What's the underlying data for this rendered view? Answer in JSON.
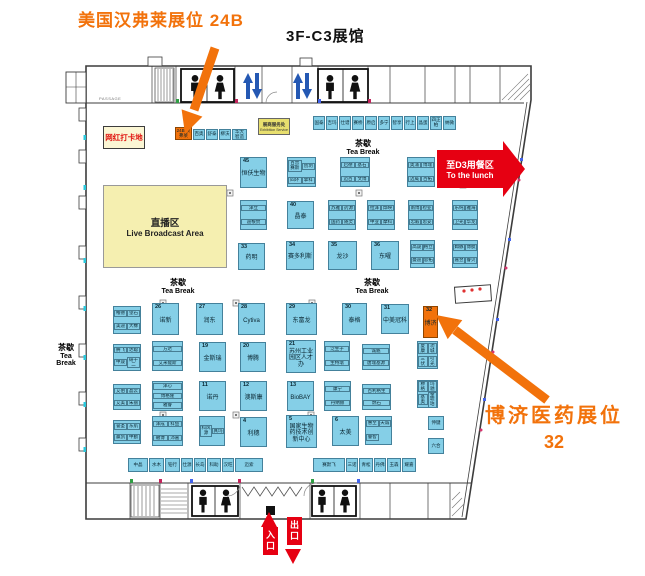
{
  "title": "3F-C3展馆",
  "annotations": {
    "humphrey": "美国汉弗莱展位 24B",
    "boji_line1": "博济医药展位",
    "boji_line2": "32"
  },
  "labels": {
    "tea_cn": "茶歇",
    "tea_en": "Tea Break",
    "photo_spot": "网红打卡地",
    "live_cn": "直播区",
    "live_en": "Live Broadcast Area",
    "service_cn": "展商服务处",
    "service_en": "Exhibition Service",
    "lunch_cn": "至D3用餐区",
    "lunch_en": "To the lunch",
    "entrance": "入口",
    "exit": "出口",
    "passage": "PASSAGE"
  },
  "colors": {
    "booth_blue": "#85CFE7",
    "highlight_orange": "#F2720B",
    "red": "#E60012",
    "area_yellow": "#F5EFB0"
  },
  "tea_break_spots": [
    {
      "x": 363,
      "y": 138,
      "v": false
    },
    {
      "x": 178,
      "y": 277,
      "v": false
    },
    {
      "x": 372,
      "y": 277,
      "v": false
    },
    {
      "x": 66,
      "y": 342,
      "v": true
    }
  ],
  "booths": [
    {
      "x": 175,
      "y": 127,
      "w": 17,
      "h": 13,
      "num": "24B",
      "label": "汉弗莱",
      "color": "orange",
      "mini": true
    },
    {
      "x": 193,
      "y": 129,
      "w": 12,
      "h": 11,
      "label": "百奥",
      "mini": true
    },
    {
      "x": 206,
      "y": 129,
      "w": 12,
      "h": 11,
      "label": "舒泰",
      "mini": true
    },
    {
      "x": 219,
      "y": 129,
      "w": 12,
      "h": 11,
      "label": "柳沃",
      "mini": true
    },
    {
      "x": 232,
      "y": 129,
      "w": 15,
      "h": 11,
      "label": "华大智造",
      "mini": true
    },
    {
      "x": 313,
      "y": 116,
      "w": 12,
      "h": 14,
      "label": "国泰",
      "mini": true
    },
    {
      "x": 326,
      "y": 116,
      "w": 12,
      "h": 14,
      "label": "吉玛",
      "mini": true
    },
    {
      "x": 339,
      "y": 116,
      "w": 12,
      "h": 14,
      "label": "仕谱",
      "mini": true
    },
    {
      "x": 352,
      "y": 116,
      "w": 12,
      "h": 14,
      "label": "赛桥",
      "mini": true
    },
    {
      "x": 365,
      "y": 116,
      "w": 12,
      "h": 14,
      "label": "原启",
      "mini": true
    },
    {
      "x": 378,
      "y": 116,
      "w": 12,
      "h": 14,
      "label": "多宁",
      "mini": true
    },
    {
      "x": 391,
      "y": 116,
      "w": 12,
      "h": 14,
      "label": "智享",
      "mini": true
    },
    {
      "x": 404,
      "y": 116,
      "w": 12,
      "h": 14,
      "label": "行上",
      "mini": true
    },
    {
      "x": 417,
      "y": 116,
      "w": 12,
      "h": 14,
      "label": "晶蛋",
      "mini": true
    },
    {
      "x": 430,
      "y": 116,
      "w": 12,
      "h": 14,
      "label": "四正柏",
      "mini": true
    },
    {
      "x": 443,
      "y": 116,
      "w": 13,
      "h": 14,
      "label": "纳微",
      "mini": true
    },
    {
      "x": 240,
      "y": 157,
      "w": 27,
      "h": 31,
      "num": "45",
      "label": "恒仸生物"
    },
    {
      "x": 287,
      "y": 157,
      "w": 29,
      "h": 30,
      "cells": [
        "百普赛斯",
        "创玥",
        "四环",
        "擎科"
      ]
    },
    {
      "x": 340,
      "y": 157,
      "w": 30,
      "h": 30,
      "cells": [
        "启德",
        "基石",
        "迈百",
        "文博"
      ]
    },
    {
      "x": 407,
      "y": 157,
      "w": 28,
      "h": 30,
      "cells": [
        "奥浦",
        "博瑞",
        "迈威",
        "百拓"
      ]
    },
    {
      "x": 455,
      "y": 157,
      "w": 26,
      "h": 30,
      "cells": [
        "老实",
        "华临",
        "开科",
        "茂行"
      ]
    },
    {
      "x": 240,
      "y": 200,
      "w": 27,
      "h": 30,
      "cells": [
        "泽立",
        "迪根赞"
      ],
      "cols": 1
    },
    {
      "x": 287,
      "y": 201,
      "w": 27,
      "h": 28,
      "num": "40",
      "label": "晶泰"
    },
    {
      "x": 328,
      "y": 200,
      "w": 28,
      "h": 30,
      "cells": [
        "苏雅",
        "药源",
        "国药",
        "随灵"
      ]
    },
    {
      "x": 367,
      "y": 200,
      "w": 28,
      "h": 30,
      "cells": [
        "拉泽",
        "烨映",
        "中亚",
        "摩科"
      ]
    },
    {
      "x": 408,
      "y": 200,
      "w": 26,
      "h": 30,
      "cells": [
        "南博",
        "检亚",
        "忠毅",
        "思妥"
      ]
    },
    {
      "x": 452,
      "y": 200,
      "w": 26,
      "h": 30,
      "cells": [
        "乐纯",
        "雅海",
        "卫光",
        "华龙"
      ]
    },
    {
      "x": 238,
      "y": 243,
      "w": 27,
      "h": 27,
      "num": "33",
      "label": "药明"
    },
    {
      "x": 286,
      "y": 241,
      "w": 28,
      "h": 29,
      "num": "34",
      "label": "赛多利斯"
    },
    {
      "x": 328,
      "y": 241,
      "w": 29,
      "h": 29,
      "num": "35",
      "label": "龙沙"
    },
    {
      "x": 371,
      "y": 241,
      "w": 28,
      "h": 29,
      "num": "36",
      "label": "东曜"
    },
    {
      "x": 410,
      "y": 240,
      "w": 25,
      "h": 28,
      "cells": [
        "高晟",
        "格立",
        "曼迪",
        "思拓"
      ]
    },
    {
      "x": 452,
      "y": 240,
      "w": 26,
      "h": 28,
      "cells": [
        "姆脉",
        "博肽",
        "嘉翌",
        "睿贝"
      ]
    },
    {
      "x": 113,
      "y": 306,
      "w": 28,
      "h": 28,
      "cells": [
        "榷德",
        "望石",
        "美迪",
        "大橡"
      ]
    },
    {
      "x": 152,
      "y": 303,
      "w": 27,
      "h": 32,
      "num": "26",
      "label": "诺新"
    },
    {
      "x": 196,
      "y": 303,
      "w": 27,
      "h": 32,
      "num": "27",
      "label": "润东"
    },
    {
      "x": 238,
      "y": 303,
      "w": 27,
      "h": 32,
      "num": "28",
      "label": "Cytiva"
    },
    {
      "x": 286,
      "y": 303,
      "w": 31,
      "h": 32,
      "num": "29",
      "label": "东富龙"
    },
    {
      "x": 342,
      "y": 303,
      "w": 25,
      "h": 32,
      "num": "30",
      "label": "泰格"
    },
    {
      "x": 381,
      "y": 304,
      "w": 28,
      "h": 30,
      "num": "31",
      "label": "中美冠科"
    },
    {
      "x": 423,
      "y": 306,
      "w": 15,
      "h": 32,
      "num": "32",
      "label": "博济",
      "color": "orange"
    },
    {
      "x": 113,
      "y": 344,
      "w": 28,
      "h": 27,
      "cells": [
        "腾飞",
        "达聪",
        "中晟",
        "研十二"
      ]
    },
    {
      "x": 152,
      "y": 341,
      "w": 31,
      "h": 30,
      "cells": [
        "方达",
        "艾米能斯"
      ],
      "cols": 1
    },
    {
      "x": 199,
      "y": 342,
      "w": 27,
      "h": 30,
      "num": "19",
      "label": "金斯瑞"
    },
    {
      "x": 240,
      "y": 342,
      "w": 26,
      "h": 30,
      "num": "20",
      "label": "博腾"
    },
    {
      "x": 286,
      "y": 340,
      "w": 30,
      "h": 33,
      "num": "21",
      "label": "苏州工业园区人才办"
    },
    {
      "x": 324,
      "y": 341,
      "w": 26,
      "h": 30,
      "cells": [
        "泛生子",
        "生特瑞"
      ],
      "cols": 1
    },
    {
      "x": 362,
      "y": 344,
      "w": 28,
      "h": 26,
      "cells": [
        "诚魁",
        "唐瑞基源"
      ],
      "cols": 1
    },
    {
      "x": 417,
      "y": 341,
      "w": 21,
      "h": 28,
      "cells": [
        "夏康",
        "功城",
        "三伏",
        "引光"
      ]
    },
    {
      "x": 113,
      "y": 384,
      "w": 28,
      "h": 26,
      "cells": [
        "艾伯",
        "晶云",
        "艾美",
        "朱丽"
      ]
    },
    {
      "x": 152,
      "y": 381,
      "w": 31,
      "h": 30,
      "cells": [
        "泽心",
        "博格隆",
        "雅睿"
      ],
      "cols": 1
    },
    {
      "x": 199,
      "y": 381,
      "w": 27,
      "h": 30,
      "num": "11",
      "label": "诺丹"
    },
    {
      "x": 240,
      "y": 381,
      "w": 27,
      "h": 30,
      "num": "12",
      "label": "澳斯康"
    },
    {
      "x": 287,
      "y": 381,
      "w": 27,
      "h": 30,
      "num": "13",
      "label": "BioBAY"
    },
    {
      "x": 324,
      "y": 381,
      "w": 27,
      "h": 30,
      "cells": [
        "康宁",
        "丹纳赫"
      ],
      "cols": 1
    },
    {
      "x": 362,
      "y": 384,
      "w": 29,
      "h": 26,
      "cells": [
        "百利格生",
        "燃石"
      ],
      "cols": 1
    },
    {
      "x": 417,
      "y": 380,
      "w": 21,
      "h": 28,
      "cells": [
        "穆格",
        "玛驰",
        "基奥",
        "金琥珀"
      ]
    },
    {
      "x": 113,
      "y": 420,
      "w": 28,
      "h": 24,
      "cells": [
        "誉圣",
        "东航",
        "赢凯",
        "中勤"
      ]
    },
    {
      "x": 152,
      "y": 416,
      "w": 31,
      "h": 30,
      "cells": [
        "泽成",
        "科鱼",
        "磁博",
        "沛嘉"
      ]
    },
    {
      "x": 199,
      "y": 416,
      "w": 26,
      "h": 30,
      "cells": [
        "科风源",
        "真玛"
      ],
      "cols": 2
    },
    {
      "x": 240,
      "y": 417,
      "w": 27,
      "h": 30,
      "num": "4",
      "label": "利穗"
    },
    {
      "x": 286,
      "y": 415,
      "w": 31,
      "h": 33,
      "num": "5",
      "label": "国家生物药技术创新中心"
    },
    {
      "x": 332,
      "y": 416,
      "w": 27,
      "h": 30,
      "num": "6",
      "label": "太美"
    },
    {
      "x": 365,
      "y": 416,
      "w": 27,
      "h": 29,
      "cells": [
        "惠至",
        "天诚",
        "睿智"
      ]
    },
    {
      "x": 428,
      "y": 416,
      "w": 16,
      "h": 14,
      "label": "伸键",
      "mini": true
    },
    {
      "x": 428,
      "y": 438,
      "w": 16,
      "h": 16,
      "label": "六合",
      "mini": true
    },
    {
      "x": 128,
      "y": 458,
      "w": 20,
      "h": 14,
      "label": "中晶",
      "mini": true
    },
    {
      "x": 149,
      "y": 458,
      "w": 15,
      "h": 14,
      "label": "水木",
      "mini": true
    },
    {
      "x": 165,
      "y": 458,
      "w": 15,
      "h": 14,
      "label": "铂行",
      "mini": true
    },
    {
      "x": 181,
      "y": 458,
      "w": 12,
      "h": 14,
      "label": "仕源",
      "mini": true
    },
    {
      "x": 194,
      "y": 458,
      "w": 12,
      "h": 14,
      "label": "长岛",
      "mini": true
    },
    {
      "x": 207,
      "y": 458,
      "w": 14,
      "h": 14,
      "label": "科助",
      "mini": true
    },
    {
      "x": 222,
      "y": 458,
      "w": 12,
      "h": 14,
      "label": "汉旺",
      "mini": true
    },
    {
      "x": 235,
      "y": 458,
      "w": 28,
      "h": 14,
      "label": "迈索",
      "mini": true
    },
    {
      "x": 313,
      "y": 458,
      "w": 32,
      "h": 14,
      "label": "赛默飞",
      "mini": true
    },
    {
      "x": 346,
      "y": 458,
      "w": 12,
      "h": 14,
      "label": "三诺",
      "mini": true
    },
    {
      "x": 359,
      "y": 458,
      "w": 14,
      "h": 14,
      "label": "青松",
      "mini": true
    },
    {
      "x": 374,
      "y": 458,
      "w": 12,
      "h": 14,
      "label": "丹佛",
      "mini": true
    },
    {
      "x": 387,
      "y": 458,
      "w": 14,
      "h": 14,
      "label": "玉森",
      "mini": true
    },
    {
      "x": 402,
      "y": 458,
      "w": 14,
      "h": 14,
      "label": "耀嘉",
      "mini": true
    }
  ]
}
